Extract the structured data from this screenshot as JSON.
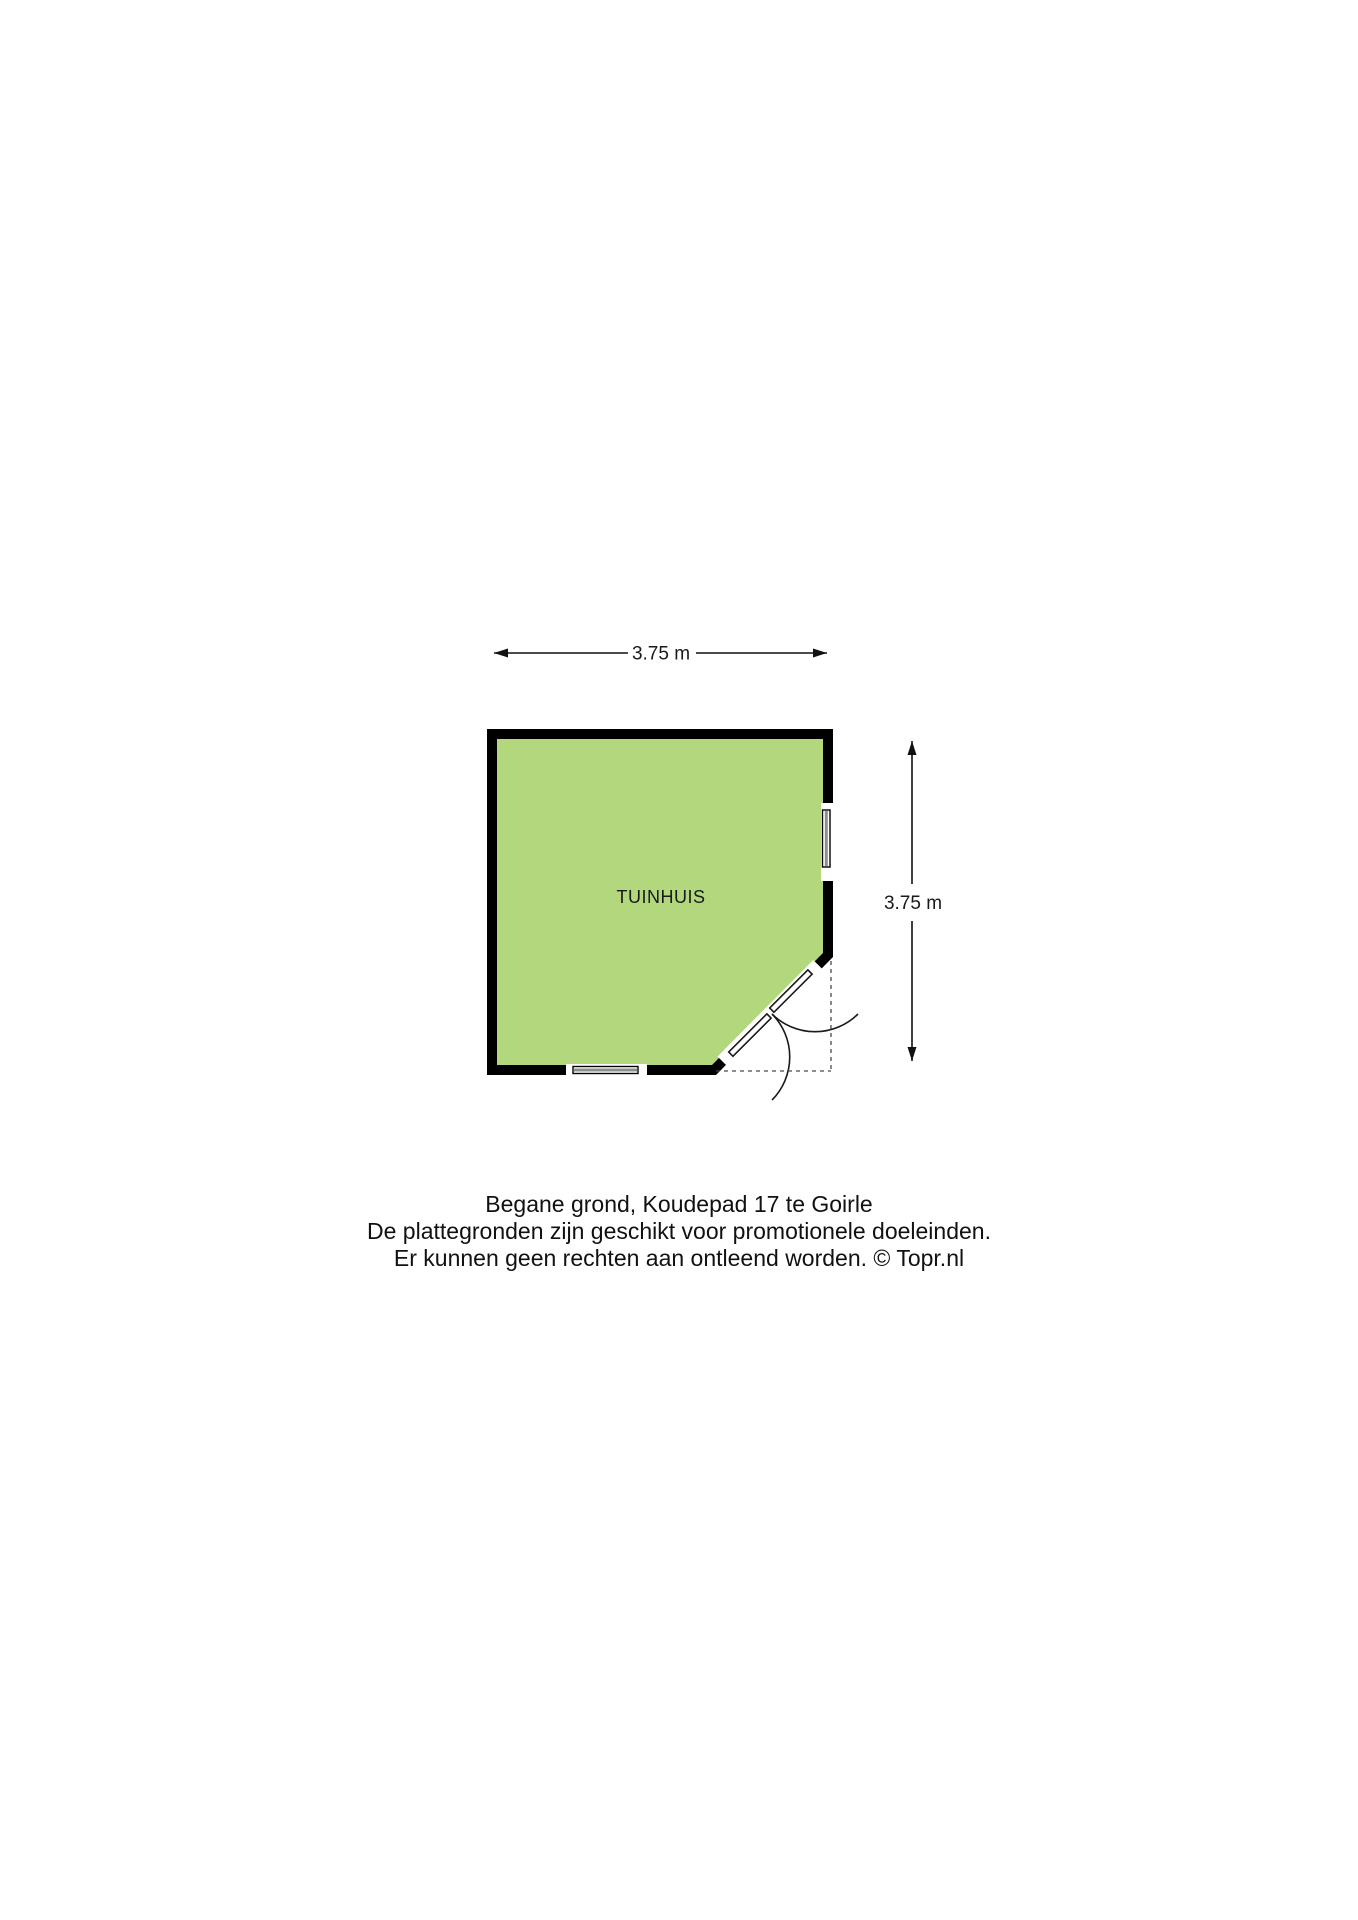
{
  "page": {
    "background": "#ffffff"
  },
  "floorplan": {
    "room": {
      "label": "TUINHUIS",
      "fill": "#b2d77d",
      "wall_color": "#000000"
    },
    "dimensions": {
      "width_label": "3.75 m",
      "height_label": "3.75 m"
    },
    "symbols": [
      "window-right-icon",
      "window-bottom-icon",
      "double-door-corner-icon",
      "dimension-arrow-horizontal-icon",
      "dimension-arrow-vertical-icon"
    ]
  },
  "caption": {
    "line1": "Begane grond, Koudepad 17 te Goirle",
    "line2": "De plattegronden zijn geschikt voor promotionele doeleinden.",
    "line3": "Er kunnen geen rechten aan ontleend worden. © Topr.nl"
  }
}
